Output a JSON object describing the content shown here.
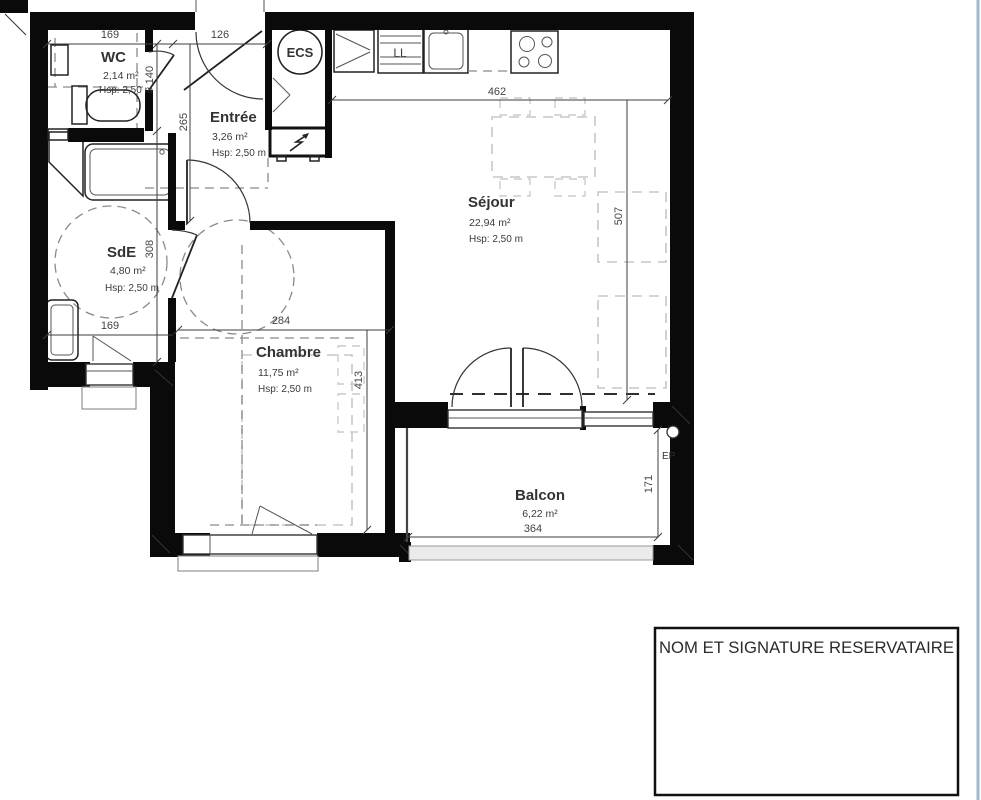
{
  "page": {
    "edge_color": "#9cb9cf"
  },
  "rooms": [
    {
      "id": "wc",
      "name": "WC",
      "area": "2,14 m²",
      "height": "Hsp: 2,50 m"
    },
    {
      "id": "entree",
      "name": "Entrée",
      "area": "3,26 m²",
      "height": "Hsp: 2,50 m"
    },
    {
      "id": "sde",
      "name": "SdE",
      "area": "4,80 m²",
      "height": "Hsp: 2,50 m"
    },
    {
      "id": "sejour",
      "name": "Séjour",
      "area": "22,94 m²",
      "height": "Hsp: 2,50 m"
    },
    {
      "id": "chambre",
      "name": "Chambre",
      "area": "11,75 m²",
      "height": "Hsp: 2,50 m"
    },
    {
      "id": "balcon",
      "name": "Balcon",
      "area": "6,22 m²",
      "height": ""
    }
  ],
  "equipment_labels": {
    "ecs": "ECS",
    "washing_machine": "LL",
    "rain_drain": "EP"
  },
  "dimensions": {
    "wc_width": "169",
    "entry_door_width": "126",
    "sejour_width": "462",
    "entree_depth": "265",
    "wc_depth": "140",
    "sde_depth": "308",
    "sde_width": "169",
    "chambre_width": "284",
    "chambre_depth": "413",
    "sejour_depth": "507",
    "balcon_width": "364",
    "balcon_depth": "171"
  },
  "signature_box": {
    "text": "NOM ET SIGNATURE RESERVATAIRE"
  }
}
